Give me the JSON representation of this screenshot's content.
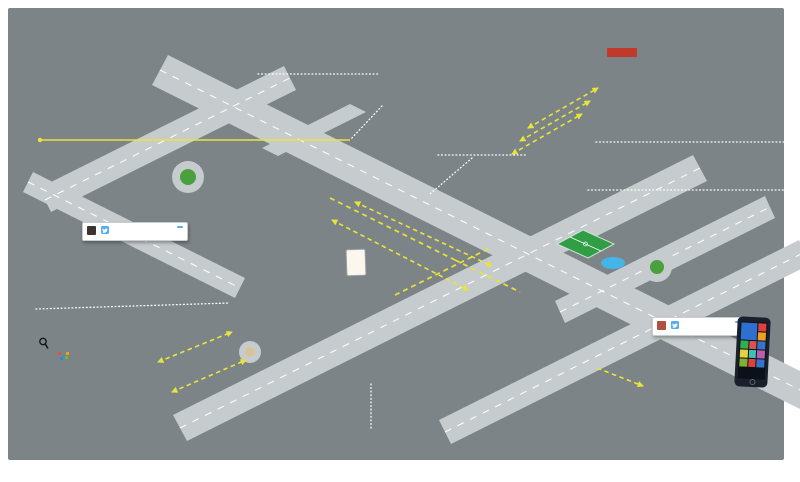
{
  "labels": {
    "universites": "UNIVERSITÉS ÉCOLES",
    "videoprotection": {
      "title": "VIDÉOPROTECTION",
      "subtitle": "Renouvellement de 269 caméras"
    },
    "eclairages": {
      "title": "ECLAIRAGES CONNECTÉS",
      "line1": "Plus de 34 000 luminaires rénovés –",
      "line2": "100% LED"
    },
    "carrefours": {
      "title1": "113 CARREFOURS",
      "title2": "ET 180 BUS",
      "subtitle": "équipés de la priorité aux bus"
    },
    "ppc": {
      "title": "PPC",
      "subtitle": "Poste de Pilotage Connecté",
      "line1": "remontée des informations",
      "line2": "en temps réel",
      "line3": "Mise en service en 2018",
      "building_sign": "PCC"
    },
    "bornes": {
      "title": "BORNES D'ACCÈS",
      "line1": "26 sites rénovés et gérés à distance,",
      "line2": "dans les zones piétonnes"
    },
    "capteurs": {
      "title": "20 CAPTEURS LoRa :",
      "line1": "des capteurs environnementaux",
      "line2": "de température, de pollution,",
      "line3": "de nuisances sonores..."
    },
    "reseaux": {
      "title": "RÉSEAUX HAUT DÉBIT",
      "line1": "Déploiement de plus de",
      "line2": "140 km de fibre optique",
      "line3": "+ Citybox®"
    },
    "surete": {
      "title1": "SÛRETÉ ET SÉCURITÉ",
      "title2": "DES BÂTIMENTS PUBLICS",
      "line1": "180 bâtiments exploités",
      "line2": "dont 13 bâtiments rénovés"
    },
    "opendata": {
      "word1": "OPEN",
      "word2": "DATA",
      "line1": "Données fiables",
      "line2": "en temps réel",
      "line3": "des délégataires",
      "line4": "et équipements"
    },
    "startups": "START UPS",
    "vehicules": {
      "title1": "205 VÉHICULES",
      "title2": "GÉOLOCALISÉS",
      "subtitle": "+130 équipés de Radio"
    },
    "livinglab": "Le LIVING LAB",
    "jei_sign": "JEI"
  },
  "tweets": {
    "velodi": {
      "name": "Cristina",
      "handle": "@Cristina",
      "follow": "Suivre",
      "parts": [
        "Les ",
        "Vélodi",
        " de la station du quartier de l'université à ",
        "#Dijon",
        " sont toujours en bon état."
      ]
    },
    "air": {
      "name": "Running Man",
      "handle": "@runningman",
      "follow": "Suivre",
      "parts": [
        "Bonne ",
        "qualité de l'air",
        " aujourd'hui à ",
        "#Dijon",
        " ! on va pouvoir aller faire un footing !"
      ]
    },
    "icons": {
      "reply": "↩",
      "retweet": "⇄",
      "favorite": "★",
      "more": "⋯"
    }
  },
  "colors": {
    "background": "#7d8487",
    "accent_yellow": "#e9e43c",
    "charcoal": "#3b4043",
    "road": "#c6cbcd",
    "white": "#ffffff",
    "twitter_blue": "#55acee",
    "living_lab_teal": "#35c4b5"
  }
}
